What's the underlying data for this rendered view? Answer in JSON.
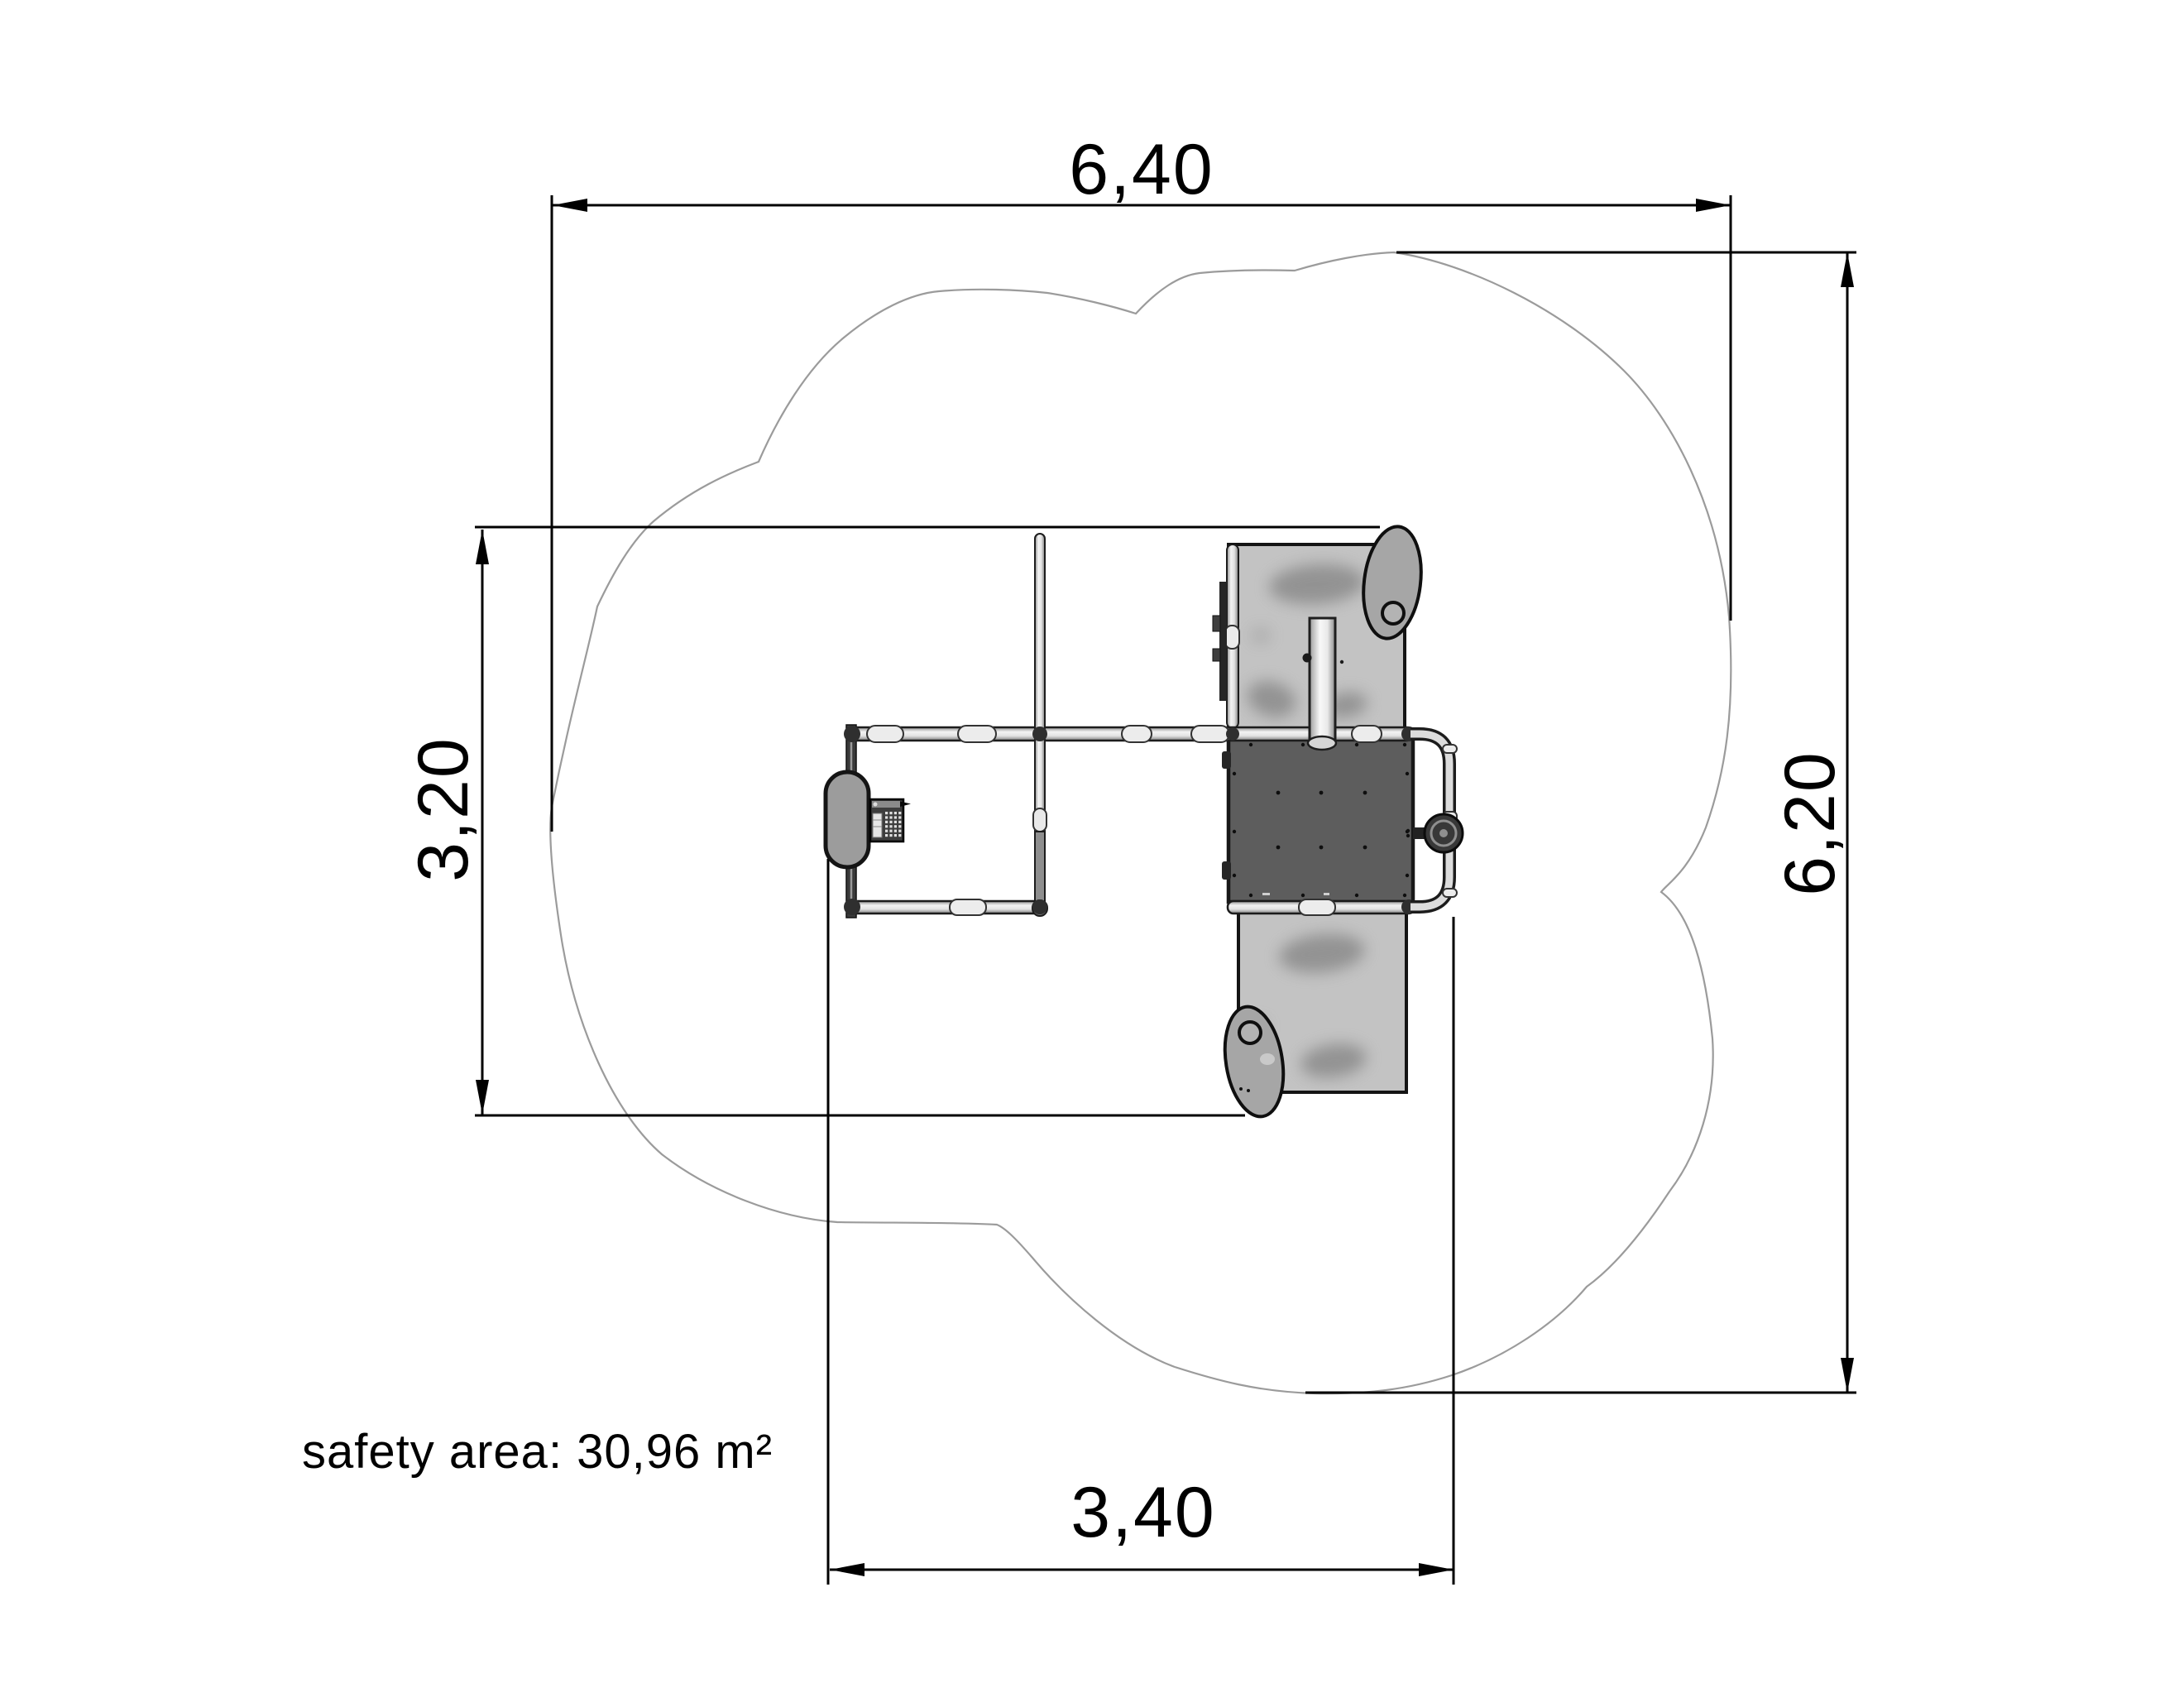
{
  "drawing": {
    "title": "playground equipment plan view with safety area",
    "dimensions": {
      "overall_width_m": "6,40",
      "overall_height_m": "6,20",
      "equipment_height_m": "3,20",
      "equipment_width_m": "3,40"
    },
    "safety_area": {
      "label": "safety area: 30,96 m²"
    },
    "colors": {
      "background": "#ffffff",
      "dimension_lines": "#000000",
      "safety_outline": "#9b9b9b",
      "platform_dark": "#5d5d5d",
      "ramp_gray": "#c3c3c3",
      "pipe_light": "#ededed",
      "seat_gray": "#9c9c9c"
    },
    "parts": [
      "safety-area-outline",
      "left-platform-frame",
      "seat",
      "game-panel",
      "divider-wall-post",
      "activity-platform-dark",
      "climbing-ramp-top",
      "climbing-ramp-bottom",
      "balance-egg-top",
      "balance-egg-bottom",
      "pole",
      "handrail-loop",
      "steering-wheel"
    ]
  }
}
